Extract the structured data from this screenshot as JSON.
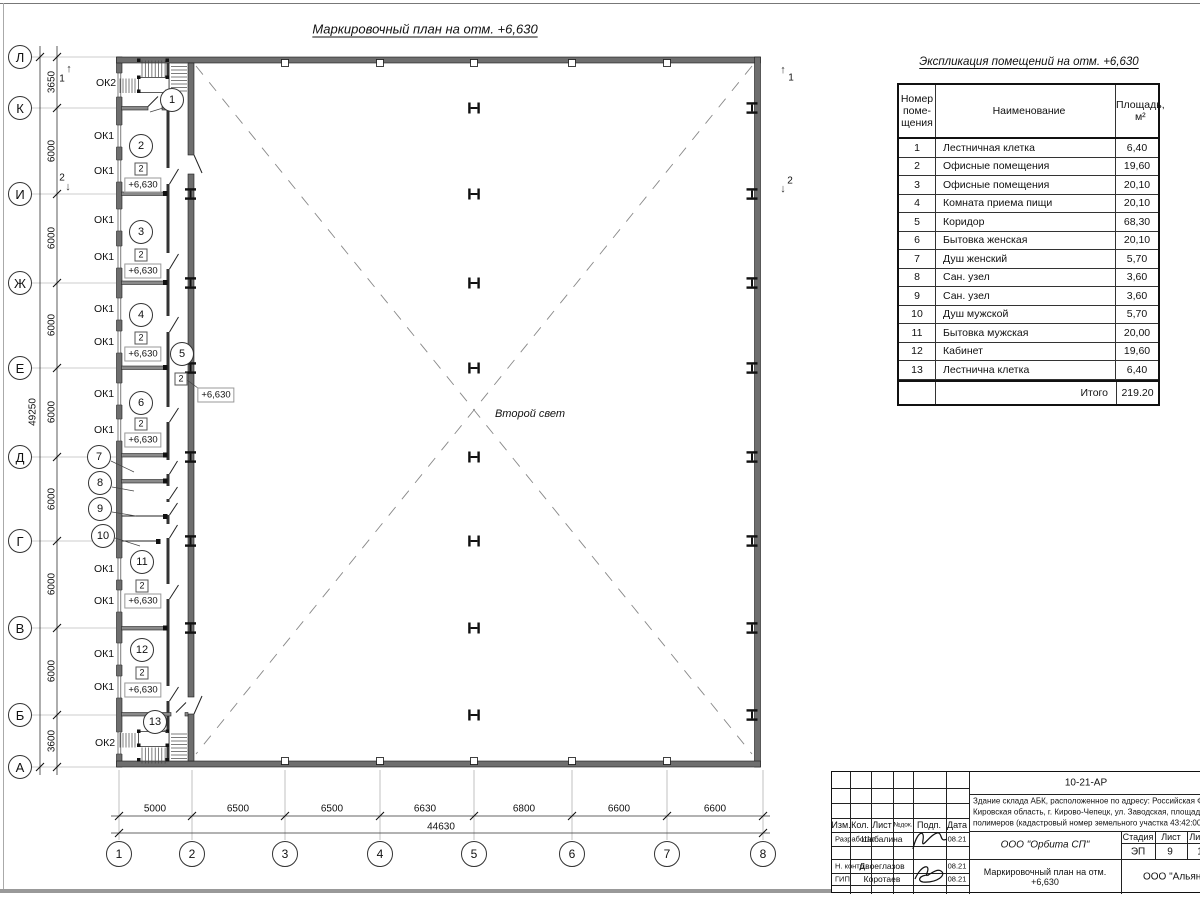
{
  "plan": {
    "title": "Маркировочный план на отм. +6,630",
    "second_light": "Второй свет",
    "labels": [
      {
        "n": "plan-title",
        "t": "Маркировочный план на отм. +6,630",
        "x": 425,
        "y": 29,
        "c": "t1"
      },
      {
        "n": "table-title",
        "t": "Экспликация помещений на отм. +6,630",
        "x": 1029,
        "y": 62,
        "c": "t2"
      },
      {
        "n": "second-light-label",
        "t": "Второй свет",
        "x": 530,
        "y": 414,
        "c": "it"
      },
      {
        "n": "window-mark-ok2",
        "t": "ОК2",
        "x": 106,
        "y": 83,
        "c": "ok"
      },
      {
        "n": "window-mark-ok1",
        "t": "ОК1",
        "x": 104,
        "y": 136,
        "c": "ok"
      },
      {
        "n": "window-mark-ok1",
        "t": "ОК1",
        "x": 104,
        "y": 171,
        "c": "ok"
      },
      {
        "n": "window-mark-ok1",
        "t": "ОК1",
        "x": 104,
        "y": 220,
        "c": "ok"
      },
      {
        "n": "window-mark-ok1",
        "t": "ОК1",
        "x": 104,
        "y": 257,
        "c": "ok"
      },
      {
        "n": "window-mark-ok1",
        "t": "ОК1",
        "x": 104,
        "y": 309,
        "c": "ok"
      },
      {
        "n": "window-mark-ok1",
        "t": "ОК1",
        "x": 104,
        "y": 342,
        "c": "ok"
      },
      {
        "n": "window-mark-ok1",
        "t": "ОК1",
        "x": 104,
        "y": 394,
        "c": "ok"
      },
      {
        "n": "window-mark-ok1",
        "t": "ОК1",
        "x": 104,
        "y": 430,
        "c": "ok"
      },
      {
        "n": "window-mark-ok1",
        "t": "ОК1",
        "x": 104,
        "y": 569,
        "c": "ok"
      },
      {
        "n": "window-mark-ok1",
        "t": "ОК1",
        "x": 104,
        "y": 601,
        "c": "ok"
      },
      {
        "n": "window-mark-ok1",
        "t": "ОК1",
        "x": 104,
        "y": 654,
        "c": "ok"
      },
      {
        "n": "window-mark-ok1",
        "t": "ОК1",
        "x": 104,
        "y": 687,
        "c": "ok"
      },
      {
        "n": "window-mark-ok2",
        "t": "ОК2",
        "x": 105,
        "y": 743,
        "c": "ok"
      },
      {
        "n": "dim-left",
        "t": "3650",
        "x": 52,
        "y": 82,
        "c": "vdim"
      },
      {
        "n": "dim-left",
        "t": "6000",
        "x": 52,
        "y": 151,
        "c": "vdim"
      },
      {
        "n": "dim-left",
        "t": "6000",
        "x": 52,
        "y": 238,
        "c": "vdim"
      },
      {
        "n": "dim-left",
        "t": "6000",
        "x": 52,
        "y": 325,
        "c": "vdim"
      },
      {
        "n": "dim-left",
        "t": "6000",
        "x": 52,
        "y": 412,
        "c": "vdim"
      },
      {
        "n": "dim-left",
        "t": "6000",
        "x": 52,
        "y": 499,
        "c": "vdim"
      },
      {
        "n": "dim-left",
        "t": "6000",
        "x": 52,
        "y": 584,
        "c": "vdim"
      },
      {
        "n": "dim-left",
        "t": "6000",
        "x": 52,
        "y": 671,
        "c": "vdim"
      },
      {
        "n": "dim-left",
        "t": "3600",
        "x": 52,
        "y": 741,
        "c": "vdim"
      },
      {
        "n": "dim-left-total",
        "t": "49250",
        "x": 33,
        "y": 412,
        "c": "vdim"
      },
      {
        "n": "dim-bottom",
        "t": "5000",
        "x": 155,
        "y": 809,
        "c": "dim"
      },
      {
        "n": "dim-bottom",
        "t": "6500",
        "x": 238,
        "y": 809,
        "c": "dim"
      },
      {
        "n": "dim-bottom",
        "t": "6500",
        "x": 332,
        "y": 809,
        "c": "dim"
      },
      {
        "n": "dim-bottom",
        "t": "6630",
        "x": 425,
        "y": 809,
        "c": "dim"
      },
      {
        "n": "dim-bottom",
        "t": "6800",
        "x": 524,
        "y": 809,
        "c": "dim"
      },
      {
        "n": "dim-bottom",
        "t": "6600",
        "x": 619,
        "y": 809,
        "c": "dim"
      },
      {
        "n": "dim-bottom",
        "t": "6600",
        "x": 715,
        "y": 809,
        "c": "dim"
      },
      {
        "n": "dim-bottom-total",
        "t": "44630",
        "x": 441,
        "y": 827,
        "c": "dim"
      },
      {
        "n": "section-mark-1",
        "t": "1",
        "x": 62,
        "y": 79,
        "c": "dim"
      },
      {
        "n": "section-mark-2",
        "t": "2",
        "x": 62,
        "y": 178,
        "c": "dim"
      },
      {
        "n": "section-mark-1",
        "t": "1",
        "x": 791,
        "y": 78,
        "c": "dim"
      },
      {
        "n": "section-mark-2",
        "t": "2",
        "x": 790,
        "y": 181,
        "c": "dim"
      },
      {
        "n": "section-arrow-icon",
        "t": "↑",
        "x": 69,
        "y": 69,
        "c": "arr"
      },
      {
        "n": "section-arrow-icon",
        "t": "↓",
        "x": 68,
        "y": 187,
        "c": "arr"
      },
      {
        "n": "section-arrow-icon",
        "t": "↑",
        "x": 783,
        "y": 70,
        "c": "arr"
      },
      {
        "n": "section-arrow-icon",
        "t": "↓",
        "x": 783,
        "y": 189,
        "c": "arr"
      },
      {
        "n": "level-mark",
        "t": "+6,630",
        "x": 143,
        "y": 185,
        "c": "lvl"
      },
      {
        "n": "level-mark",
        "t": "+6,630",
        "x": 143,
        "y": 271,
        "c": "lvl"
      },
      {
        "n": "level-mark",
        "t": "+6,630",
        "x": 143,
        "y": 354,
        "c": "lvl"
      },
      {
        "n": "level-mark",
        "t": "+6,630",
        "x": 143,
        "y": 440,
        "c": "lvl"
      },
      {
        "n": "level-mark",
        "t": "+6,630",
        "x": 143,
        "y": 601,
        "c": "lvl"
      },
      {
        "n": "level-mark",
        "t": "+6,630",
        "x": 143,
        "y": 690,
        "c": "lvl"
      },
      {
        "n": "level-mark",
        "t": "+6,630",
        "x": 216,
        "y": 395,
        "c": "lvl"
      },
      {
        "n": "floor-type-mark",
        "t": "2",
        "x": 141,
        "y": 169,
        "c": "sq"
      },
      {
        "n": "floor-type-mark",
        "t": "2",
        "x": 141,
        "y": 255,
        "c": "sq"
      },
      {
        "n": "floor-type-mark",
        "t": "2",
        "x": 141,
        "y": 338,
        "c": "sq"
      },
      {
        "n": "floor-type-mark",
        "t": "2",
        "x": 141,
        "y": 424,
        "c": "sq"
      },
      {
        "n": "floor-type-mark",
        "t": "2",
        "x": 181,
        "y": 379,
        "c": "sq"
      },
      {
        "n": "floor-type-mark",
        "t": "2",
        "x": 142,
        "y": 586,
        "c": "sq"
      },
      {
        "n": "floor-type-mark",
        "t": "2",
        "x": 142,
        "y": 673,
        "c": "sq"
      }
    ],
    "bubbles": [
      {
        "n": "grid-row-bubble",
        "t": "Л",
        "x": 20,
        "y": 57,
        "r": 12,
        "f": 13
      },
      {
        "n": "grid-row-bubble",
        "t": "К",
        "x": 20,
        "y": 108,
        "r": 12,
        "f": 13
      },
      {
        "n": "grid-row-bubble",
        "t": "И",
        "x": 20,
        "y": 194,
        "r": 12,
        "f": 13
      },
      {
        "n": "grid-row-bubble",
        "t": "Ж",
        "x": 20,
        "y": 283,
        "r": 12,
        "f": 13
      },
      {
        "n": "grid-row-bubble",
        "t": "Е",
        "x": 20,
        "y": 368,
        "r": 12,
        "f": 13
      },
      {
        "n": "grid-row-bubble",
        "t": "Д",
        "x": 20,
        "y": 457,
        "r": 12,
        "f": 13
      },
      {
        "n": "grid-row-bubble",
        "t": "Г",
        "x": 20,
        "y": 541,
        "r": 12,
        "f": 13
      },
      {
        "n": "grid-row-bubble",
        "t": "В",
        "x": 20,
        "y": 628,
        "r": 12,
        "f": 13
      },
      {
        "n": "grid-row-bubble",
        "t": "Б",
        "x": 20,
        "y": 715,
        "r": 12,
        "f": 13
      },
      {
        "n": "grid-row-bubble",
        "t": "А",
        "x": 20,
        "y": 767,
        "r": 12,
        "f": 13
      },
      {
        "n": "grid-col-bubble",
        "t": "1",
        "x": 119,
        "y": 854,
        "r": 13,
        "f": 12
      },
      {
        "n": "grid-col-bubble",
        "t": "2",
        "x": 192,
        "y": 854,
        "r": 13,
        "f": 12
      },
      {
        "n": "grid-col-bubble",
        "t": "3",
        "x": 285,
        "y": 854,
        "r": 13,
        "f": 12
      },
      {
        "n": "grid-col-bubble",
        "t": "4",
        "x": 380,
        "y": 854,
        "r": 13,
        "f": 12
      },
      {
        "n": "grid-col-bubble",
        "t": "5",
        "x": 474,
        "y": 854,
        "r": 13,
        "f": 12
      },
      {
        "n": "grid-col-bubble",
        "t": "6",
        "x": 572,
        "y": 854,
        "r": 13,
        "f": 12
      },
      {
        "n": "grid-col-bubble",
        "t": "7",
        "x": 667,
        "y": 854,
        "r": 13,
        "f": 12
      },
      {
        "n": "grid-col-bubble",
        "t": "8",
        "x": 763,
        "y": 854,
        "r": 13,
        "f": 12
      },
      {
        "n": "room-number-bubble",
        "t": "1",
        "x": 172,
        "y": 100,
        "r": 12,
        "f": 11
      },
      {
        "n": "room-number-bubble",
        "t": "2",
        "x": 141,
        "y": 146,
        "r": 12,
        "f": 11
      },
      {
        "n": "room-number-bubble",
        "t": "3",
        "x": 141,
        "y": 232,
        "r": 12,
        "f": 11
      },
      {
        "n": "room-number-bubble",
        "t": "4",
        "x": 141,
        "y": 315,
        "r": 12,
        "f": 11
      },
      {
        "n": "room-number-bubble",
        "t": "5",
        "x": 182,
        "y": 354,
        "r": 12,
        "f": 11
      },
      {
        "n": "room-number-bubble",
        "t": "6",
        "x": 141,
        "y": 403,
        "r": 12,
        "f": 11
      },
      {
        "n": "room-number-bubble",
        "t": "7",
        "x": 99,
        "y": 457,
        "r": 12,
        "f": 11
      },
      {
        "n": "room-number-bubble",
        "t": "8",
        "x": 100,
        "y": 483,
        "r": 12,
        "f": 11
      },
      {
        "n": "room-number-bubble",
        "t": "9",
        "x": 100,
        "y": 509,
        "r": 12,
        "f": 11
      },
      {
        "n": "room-number-bubble",
        "t": "10",
        "x": 103,
        "y": 536,
        "r": 12,
        "f": 11
      },
      {
        "n": "room-number-bubble",
        "t": "11",
        "x": 142,
        "y": 562,
        "r": 12,
        "f": 11
      },
      {
        "n": "room-number-bubble",
        "t": "12",
        "x": 142,
        "y": 650,
        "r": 12,
        "f": 11
      },
      {
        "n": "room-number-bubble",
        "t": "13",
        "x": 155,
        "y": 722,
        "r": 12,
        "f": 11
      }
    ]
  },
  "table": {
    "title": "Экспликация помещений на отм. +6,630",
    "col_headers": [
      "Номер\nпоме-\nщения",
      "Наименование",
      "Площадь,\nм²"
    ],
    "rows": [
      [
        "1",
        "Лестничная клетка",
        "6,40"
      ],
      [
        "2",
        "Офисные помещения",
        "19,60"
      ],
      [
        "3",
        "Офисные помещения",
        "20,10"
      ],
      [
        "4",
        "Комната приема пищи",
        "20,10"
      ],
      [
        "5",
        "Коридор",
        "68,30"
      ],
      [
        "6",
        "Бытовка женская",
        "20,10"
      ],
      [
        "7",
        "Душ женский",
        "5,70"
      ],
      [
        "8",
        "Сан. узел",
        "3,60"
      ],
      [
        "9",
        "Сан. узел",
        "3,60"
      ],
      [
        "10",
        "Душ мужской",
        "5,70"
      ],
      [
        "11",
        "Бытовка мужская",
        "20,00"
      ],
      [
        "12",
        "Кабинет",
        "19,60"
      ],
      [
        "13",
        "Лестнична клетка",
        "6,40"
      ]
    ],
    "total_label": "Итого",
    "total_value": "219.20"
  },
  "titleblock": {
    "code": "10-21-АР",
    "desc_lines": [
      "Здание склада АБК, расположенное по адресу: Российская Феде",
      "Кировская область, г. Кирово-Чепецк, ул. Заводская, площадка з",
      "полимеров (кадастровый номер земельного участка 43:42:0000"
    ],
    "cols": [
      "Изм.",
      "Кол.",
      "Лист",
      "№док.",
      "Подп.",
      "Дата"
    ],
    "rows": [
      {
        "role": "Разработал",
        "name": "Шабалина",
        "date": "08.21"
      },
      {
        "role": "Н. контр.",
        "name": "Двоеглазов",
        "date": "08.21"
      },
      {
        "role": "ГИП",
        "name": "Коротаев",
        "date": "08.21"
      }
    ],
    "org": "ООО \"Орбита СП\"",
    "stage_label": "Стадия",
    "sheet_label": "Лист",
    "sheets_label": "Листов",
    "stage": "ЭП",
    "sheet": "9",
    "sheets": "1",
    "doc_title": "Маркировочный план на отм.\n+6,630",
    "company": "ООО \"Альянс"
  }
}
